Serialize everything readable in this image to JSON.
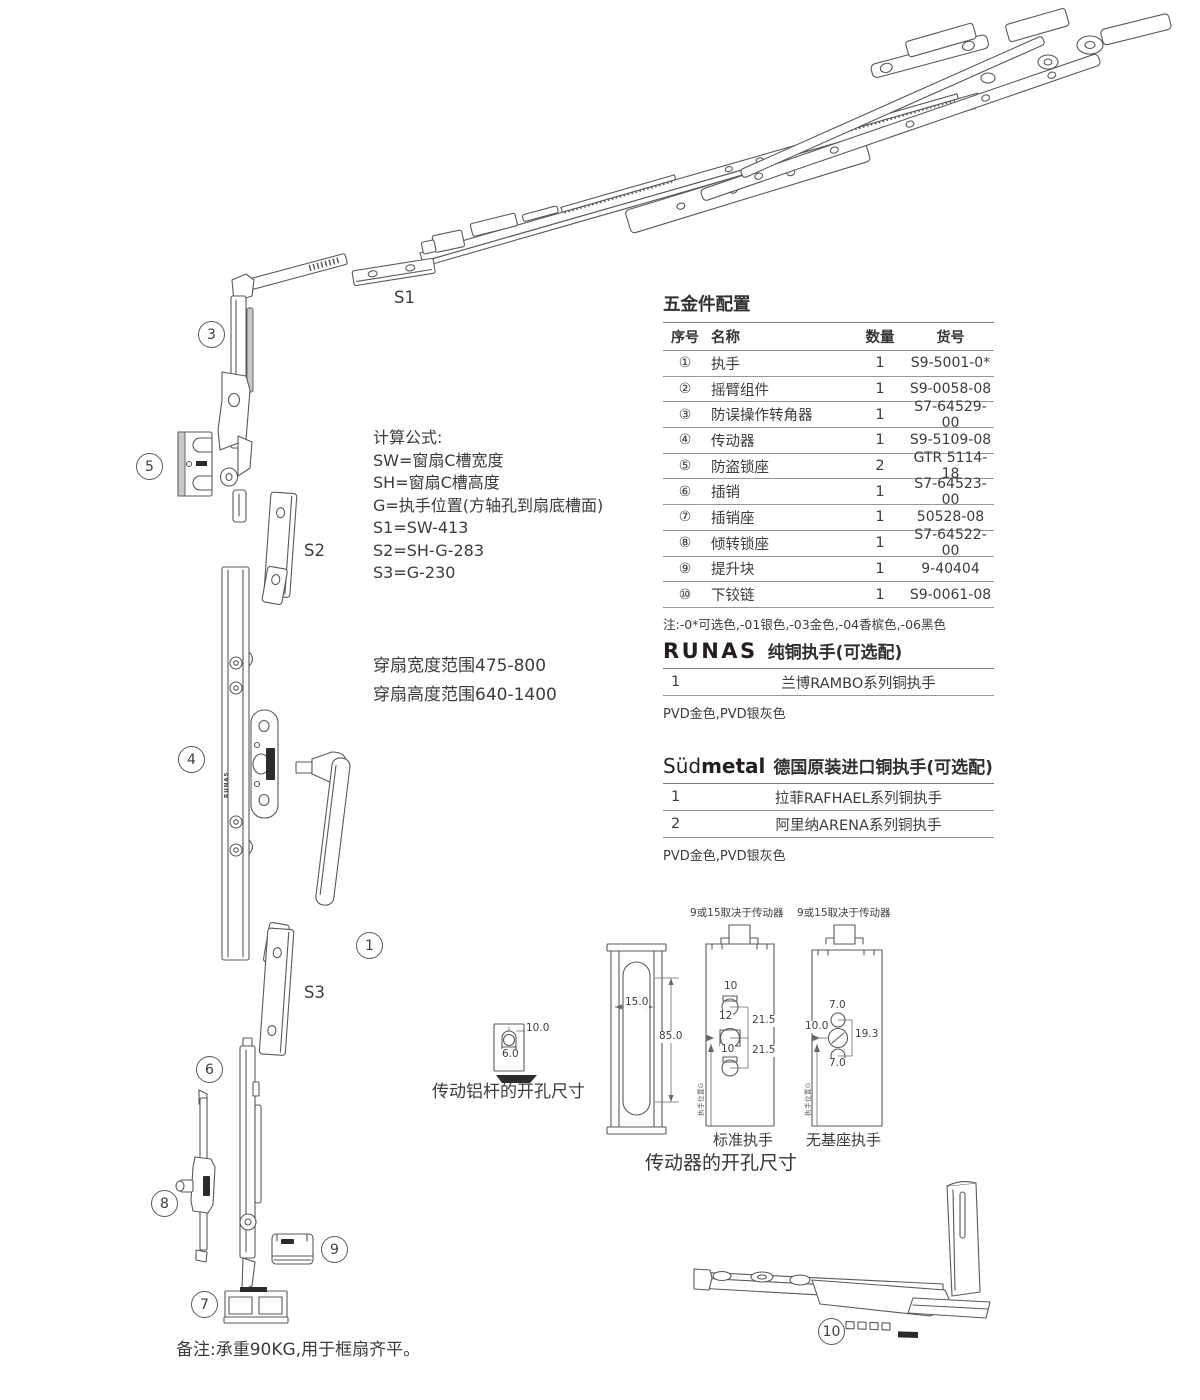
{
  "diagram": {
    "part_labels": {
      "s1": "S1",
      "s2": "S2",
      "s3": "S3"
    },
    "callouts": {
      "c1": "1",
      "c3": "3",
      "c4": "4",
      "c5": "5",
      "c6": "6",
      "c7": "7",
      "c8": "8",
      "c9": "9",
      "c10": "10"
    },
    "brand_vertical": "RUNAS"
  },
  "formulas": {
    "title": "计算公式:",
    "lines": [
      "SW=窗扇C槽宽度",
      "SH=窗扇C槽高度",
      "G=执手位置(方轴孔到扇底槽面)",
      "S1=SW-413",
      "S2=SH-G-283",
      "S3=G-230"
    ]
  },
  "ranges": {
    "width": "穿扇宽度范围475-800",
    "height": "穿扇高度范围640-1400"
  },
  "hardware_table": {
    "title": "五金件配置",
    "headers": [
      "序号",
      "名称",
      "数量",
      "货号"
    ],
    "rows": [
      {
        "no": "①",
        "name": "执手",
        "qty": "1",
        "code": "S9-5001-0*"
      },
      {
        "no": "②",
        "name": "摇臂组件",
        "qty": "1",
        "code": "S9-0058-08"
      },
      {
        "no": "③",
        "name": "防误操作转角器",
        "qty": "1",
        "code": "S7-64529-00"
      },
      {
        "no": "④",
        "name": "传动器",
        "qty": "1",
        "code": "S9-5109-08"
      },
      {
        "no": "⑤",
        "name": "防盗锁座",
        "qty": "2",
        "code": "GTR 5114-18"
      },
      {
        "no": "⑥",
        "name": "插销",
        "qty": "1",
        "code": "S7-64523-00"
      },
      {
        "no": "⑦",
        "name": "插销座",
        "qty": "1",
        "code": "50528-08"
      },
      {
        "no": "⑧",
        "name": "倾转锁座",
        "qty": "1",
        "code": "S7-64522-00"
      },
      {
        "no": "⑨",
        "name": "提升块",
        "qty": "1",
        "code": "9-40404"
      },
      {
        "no": "⑩",
        "name": "下铰链",
        "qty": "1",
        "code": "S9-0061-08"
      }
    ],
    "note": "注:-0*可选色,-01银色,-03金色,-04香槟色,-06黑色"
  },
  "runas_option": {
    "brand": "RUNAS",
    "title": "纯铜执手(可选配)",
    "rows": [
      {
        "no": "1",
        "name": "兰博RAMBO系列铜执手"
      }
    ],
    "finishes": "PVD金色,PVD银灰色"
  },
  "sudmetal_option": {
    "brand_light": "Süd",
    "brand_bold": "metal",
    "title": "德国原装进口铜执手(可选配)",
    "rows": [
      {
        "no": "1",
        "name": "拉菲RAFHAEL系列铜执手"
      },
      {
        "no": "2",
        "name": "阿里纳ARENA系列铜执手"
      }
    ],
    "finishes": "PVD金色,PVD银灰色"
  },
  "drill_drawings": {
    "rod": {
      "caption": "传动铝杆的开孔尺寸",
      "dims": {
        "slot": "10.0",
        "hole": "6.0"
      }
    },
    "gearbox_caption": "传动器的开孔尺寸",
    "profile": {
      "dims": {
        "width": "15.0",
        "height": "85.0"
      }
    },
    "standard": {
      "top_note": "9或15取决于传动器",
      "caption": "标准执手",
      "axis_label": "执手位置G",
      "dims": {
        "d1": "10",
        "d2": "12",
        "d3": "21.5",
        "d4": "21.5",
        "d5": "10"
      }
    },
    "no_base": {
      "top_note": "9或15取决于传动器",
      "caption": "无基座执手",
      "axis_label": "执手位置G",
      "dims": {
        "d1": "7.0",
        "d2": "10.0",
        "d3": "19.3",
        "d4": "7.0"
      }
    }
  },
  "footer_note": "备注:承重90KG,用于框扇齐平。"
}
